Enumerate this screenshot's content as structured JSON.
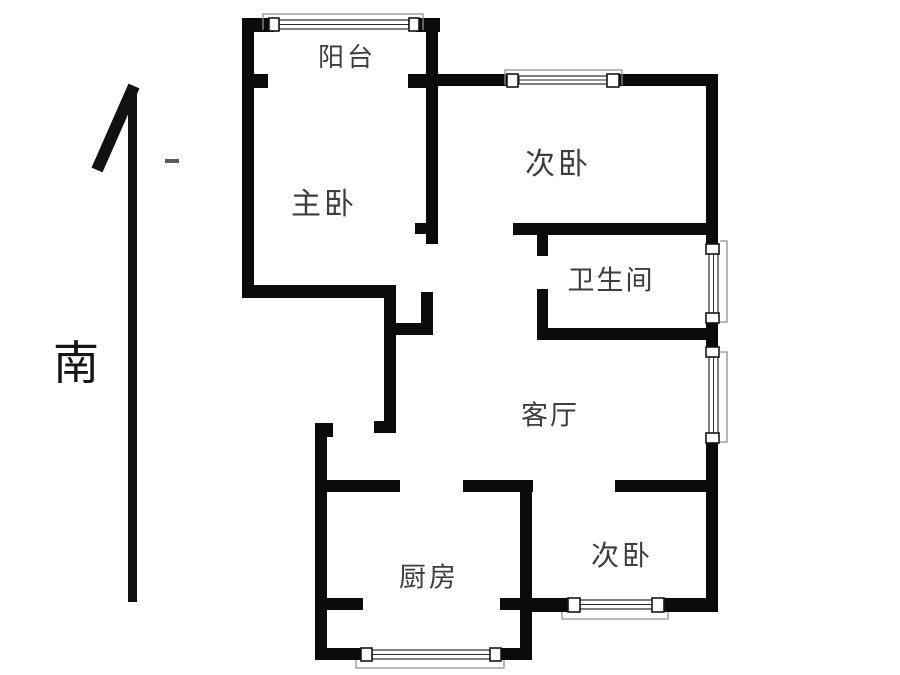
{
  "compass": {
    "south_label": "南"
  },
  "rooms": {
    "balcony": "阳台",
    "master_bedroom": "主卧",
    "bedroom_top": "次卧",
    "bathroom": "卫生间",
    "living_room": "客厅",
    "kitchen": "厨房",
    "bedroom_bottom": "次卧"
  },
  "colors": {
    "wall": "#0b0b0b",
    "background": "#ffffff",
    "label": "#3d3d3d",
    "window_line": "#2b2b2b"
  }
}
